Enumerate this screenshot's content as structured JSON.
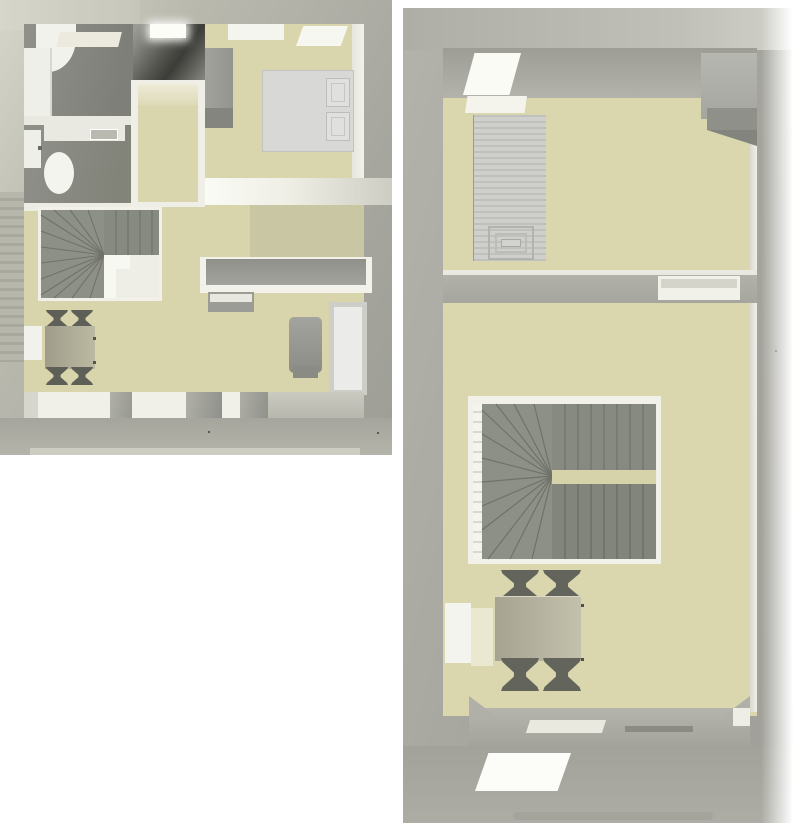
{
  "page": {
    "title": "3D dollhouse floor plan renders",
    "background": "#ffffff"
  },
  "palette": {
    "floor_beige": "#d8d4ab",
    "floor_gray": "#8e8f88",
    "wall_outer_light": "#c9c9bd",
    "wall_outer_gray": "#a3a39c",
    "wall_inner_white": "#f0efe8",
    "stair_gray": "#8d9087",
    "stair_edge": "#6f7268",
    "furniture_dark": "#5e5f57",
    "furniture_light": "#ececea",
    "bed_white": "#d8d8d6"
  },
  "floor_plans": [
    {
      "name": "First floor plan",
      "rooms": [
        "bathroom",
        "wc",
        "stair void",
        "hallway",
        "bedroom",
        "living room",
        "kitchen-dining"
      ],
      "furniture": [
        "corner bathtub",
        "vanity counter",
        "wall shelf",
        "washbasin",
        "toilet",
        "skylight",
        "wardrobe",
        "double bed with two pillows",
        "windows",
        "winder staircase",
        "kitchen counter",
        "sideboard",
        "armchair",
        "sofa",
        "dining table",
        "four chairs"
      ]
    },
    {
      "name": "Second floor plan",
      "rooms": [
        "attic bedroom",
        "stair landing",
        "dining room"
      ],
      "furniture": [
        "roof skylight",
        "wardrobe",
        "striped single bed",
        "wall niche",
        "U-shaped winder staircase with railing",
        "dining table",
        "four chairs",
        "window",
        "roof window"
      ]
    }
  ]
}
